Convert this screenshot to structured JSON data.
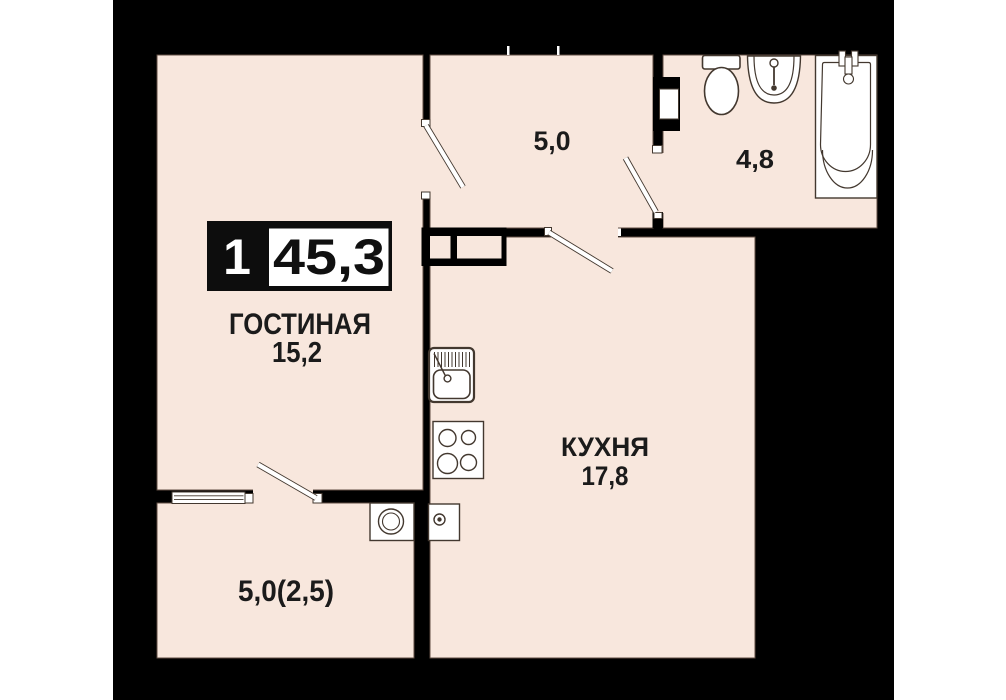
{
  "apartment": {
    "rooms_count": "1",
    "total_area": "45,3"
  },
  "rooms": {
    "living": {
      "name": "ГОСТИНАЯ",
      "area": "15,2"
    },
    "kitchen": {
      "name": "КУХНЯ",
      "area": "17,8"
    },
    "hallway": {
      "area": "5,0"
    },
    "bathroom": {
      "area": "4,8"
    },
    "balcony": {
      "area": "5,0(2,5)"
    }
  },
  "colors": {
    "page_margin": "#ffffff",
    "plan_background": "#000000",
    "floor": "#f8e7dd",
    "room_outline": "#5f4d42",
    "fixture_line": "#43382f",
    "badge_background": "#0d0d0d",
    "badge_area_box": "#ffffff",
    "label_text": "#1b1b1b"
  },
  "fixtures": [
    "toilet-icon",
    "washbasin-icon",
    "bathtub-icon",
    "kitchen-sink-icon",
    "stove-icon",
    "boiler-icon",
    "washing-machine-icon",
    "wardrobe-icon",
    "balcony-window-icon",
    "door-swing-icon"
  ]
}
